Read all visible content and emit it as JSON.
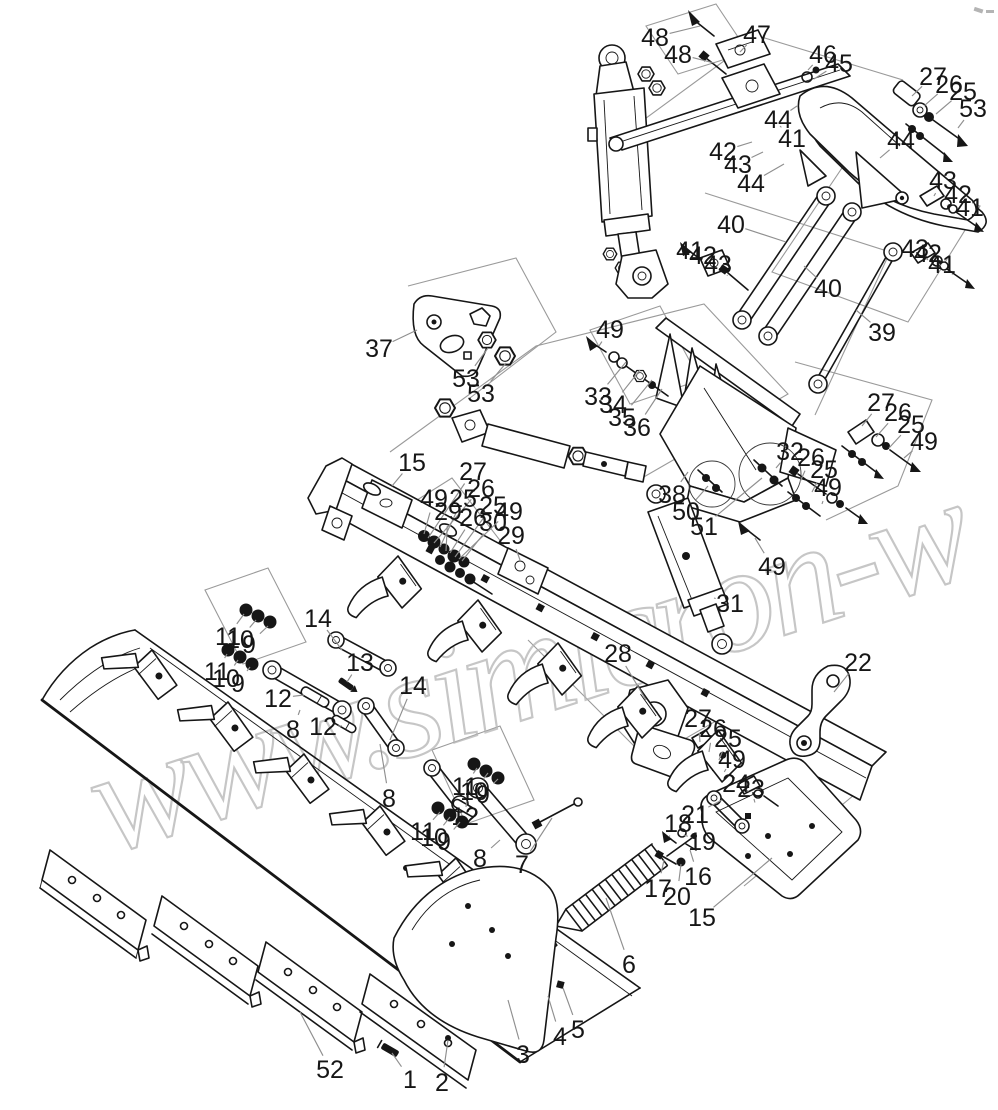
{
  "watermark": {
    "text": "www.simicron-w",
    "color": "#b4b4b4"
  },
  "diagram": {
    "background": "#ffffff",
    "colors": {
      "ink": "#161616",
      "leader": "#8f8f8f"
    },
    "callouts": [
      {
        "n": "48",
        "x": 655,
        "y": 37,
        "tx": 700,
        "ty": 26
      },
      {
        "n": "48",
        "x": 678,
        "y": 54,
        "tx": 714,
        "ty": 63
      },
      {
        "n": "47",
        "x": 757,
        "y": 34,
        "tx": 740,
        "ty": 52
      },
      {
        "n": "46",
        "x": 823,
        "y": 54,
        "tx": 808,
        "ty": 70
      },
      {
        "n": "45",
        "x": 839,
        "y": 63,
        "tx": 814,
        "ty": 79
      },
      {
        "n": "27",
        "x": 933,
        "y": 76,
        "tx": 912,
        "ty": 96
      },
      {
        "n": "26",
        "x": 949,
        "y": 84,
        "tx": 924,
        "ty": 106
      },
      {
        "n": "25",
        "x": 963,
        "y": 91,
        "tx": 936,
        "ty": 114
      },
      {
        "n": "53",
        "x": 973,
        "y": 108,
        "tx": 958,
        "ty": 128
      },
      {
        "n": "42",
        "x": 723,
        "y": 151,
        "tx": 752,
        "ty": 142
      },
      {
        "n": "43",
        "x": 738,
        "y": 164,
        "tx": 763,
        "ty": 152
      },
      {
        "n": "44",
        "x": 751,
        "y": 183,
        "tx": 784,
        "ty": 164
      },
      {
        "n": "44",
        "x": 778,
        "y": 119,
        "tx": 797,
        "ty": 106
      },
      {
        "n": "41",
        "x": 792,
        "y": 138,
        "tx": 780,
        "ty": 126
      },
      {
        "n": "44",
        "x": 901,
        "y": 140,
        "tx": 880,
        "ty": 158
      },
      {
        "n": "43",
        "x": 943,
        "y": 180,
        "tx": 934,
        "ty": 196
      },
      {
        "n": "42",
        "x": 958,
        "y": 194,
        "tx": 947,
        "ty": 206
      },
      {
        "n": "41",
        "x": 970,
        "y": 207,
        "tx": 958,
        "ty": 218
      },
      {
        "n": "43",
        "x": 915,
        "y": 248,
        "tx": 928,
        "ty": 260
      },
      {
        "n": "42",
        "x": 928,
        "y": 253,
        "tx": 941,
        "ty": 266
      },
      {
        "n": "41",
        "x": 942,
        "y": 264,
        "tx": 952,
        "ty": 274
      },
      {
        "n": "40",
        "x": 731,
        "y": 224,
        "tx": 786,
        "ty": 242
      },
      {
        "n": "41",
        "x": 690,
        "y": 250,
        "tx": 700,
        "ty": 261
      },
      {
        "n": "42",
        "x": 703,
        "y": 255,
        "tx": 712,
        "ty": 267
      },
      {
        "n": "43",
        "x": 718,
        "y": 264,
        "tx": 727,
        "ty": 275
      },
      {
        "n": "40",
        "x": 828,
        "y": 288,
        "tx": 804,
        "ty": 266
      },
      {
        "n": "39",
        "x": 882,
        "y": 332,
        "tx": 856,
        "ty": 310
      },
      {
        "n": "49",
        "x": 610,
        "y": 329,
        "tx": 599,
        "ty": 346
      },
      {
        "n": "33",
        "x": 598,
        "y": 396,
        "tx": 626,
        "ty": 362
      },
      {
        "n": "34",
        "x": 613,
        "y": 404,
        "tx": 640,
        "ty": 370
      },
      {
        "n": "35",
        "x": 622,
        "y": 417,
        "tx": 652,
        "ty": 380
      },
      {
        "n": "36",
        "x": 637,
        "y": 427,
        "tx": 662,
        "ty": 389
      },
      {
        "n": "37",
        "x": 379,
        "y": 348,
        "tx": 417,
        "ty": 330
      },
      {
        "n": "53",
        "x": 466,
        "y": 378,
        "tx": 488,
        "ty": 348
      },
      {
        "n": "53",
        "x": 481,
        "y": 393,
        "tx": 506,
        "ty": 363
      },
      {
        "n": "15",
        "x": 412,
        "y": 462,
        "tx": 392,
        "ty": 486
      },
      {
        "n": "27",
        "x": 473,
        "y": 471,
        "tx": 428,
        "ty": 538
      },
      {
        "n": "26",
        "x": 481,
        "y": 488,
        "tx": 434,
        "ty": 543
      },
      {
        "n": "49",
        "x": 434,
        "y": 498,
        "tx": 424,
        "ty": 534
      },
      {
        "n": "25",
        "x": 463,
        "y": 498,
        "tx": 440,
        "ty": 547
      },
      {
        "n": "29",
        "x": 448,
        "y": 511,
        "tx": 446,
        "ty": 551
      },
      {
        "n": "25",
        "x": 493,
        "y": 505,
        "tx": 455,
        "ty": 557
      },
      {
        "n": "26",
        "x": 473,
        "y": 517,
        "tx": 450,
        "ty": 553
      },
      {
        "n": "30",
        "x": 493,
        "y": 522,
        "tx": 462,
        "ty": 561
      },
      {
        "n": "49",
        "x": 509,
        "y": 511,
        "tx": 459,
        "ty": 559
      },
      {
        "n": "29",
        "x": 511,
        "y": 535,
        "tx": 520,
        "ty": 560
      },
      {
        "n": "32",
        "x": 790,
        "y": 451,
        "tx": 776,
        "ty": 468
      },
      {
        "n": "26",
        "x": 811,
        "y": 457,
        "tx": 800,
        "ty": 482
      },
      {
        "n": "25",
        "x": 824,
        "y": 469,
        "tx": 812,
        "ty": 492
      },
      {
        "n": "49",
        "x": 828,
        "y": 487,
        "tx": 822,
        "ty": 504
      },
      {
        "n": "27",
        "x": 881,
        "y": 402,
        "tx": 862,
        "ty": 426
      },
      {
        "n": "26",
        "x": 898,
        "y": 412,
        "tx": 876,
        "ty": 437
      },
      {
        "n": "25",
        "x": 911,
        "y": 424,
        "tx": 889,
        "ty": 448
      },
      {
        "n": "49",
        "x": 924,
        "y": 441,
        "tx": 904,
        "ty": 458
      },
      {
        "n": "38",
        "x": 672,
        "y": 494,
        "tx": 688,
        "ty": 472
      },
      {
        "n": "50",
        "x": 686,
        "y": 511,
        "tx": 708,
        "ty": 486
      },
      {
        "n": "51",
        "x": 704,
        "y": 526,
        "tx": 762,
        "ty": 478
      },
      {
        "n": "49",
        "x": 772,
        "y": 566,
        "tx": 755,
        "ty": 538
      },
      {
        "n": "28",
        "x": 618,
        "y": 653,
        "tx": 646,
        "ty": 700
      },
      {
        "n": "22",
        "x": 858,
        "y": 662,
        "tx": 834,
        "ty": 692
      },
      {
        "n": "31",
        "x": 730,
        "y": 603,
        "tx": 714,
        "ty": 598
      },
      {
        "n": "14",
        "x": 318,
        "y": 618,
        "tx": 342,
        "ty": 650
      },
      {
        "n": "13",
        "x": 360,
        "y": 662,
        "tx": 347,
        "ty": 682
      },
      {
        "n": "14",
        "x": 413,
        "y": 685,
        "tx": 390,
        "ty": 740
      },
      {
        "n": "11",
        "x": 228,
        "y": 636,
        "tx": 244,
        "ty": 614
      },
      {
        "n": "10",
        "x": 240,
        "y": 639,
        "tx": 256,
        "ty": 620
      },
      {
        "n": "9",
        "x": 249,
        "y": 644,
        "tx": 268,
        "ty": 626
      },
      {
        "n": "11",
        "x": 217,
        "y": 671,
        "tx": 227,
        "ty": 654
      },
      {
        "n": "10",
        "x": 226,
        "y": 678,
        "tx": 238,
        "ty": 660
      },
      {
        "n": "9",
        "x": 238,
        "y": 683,
        "tx": 250,
        "ty": 667
      },
      {
        "n": "12",
        "x": 278,
        "y": 698,
        "tx": 304,
        "ty": 695
      },
      {
        "n": "8",
        "x": 293,
        "y": 729,
        "tx": 300,
        "ty": 710
      },
      {
        "n": "12",
        "x": 323,
        "y": 726,
        "tx": 342,
        "ty": 726
      },
      {
        "n": "8",
        "x": 389,
        "y": 798,
        "tx": 380,
        "ty": 744
      },
      {
        "n": "11",
        "x": 465,
        "y": 786,
        "tx": 477,
        "ty": 768
      },
      {
        "n": "10",
        "x": 474,
        "y": 791,
        "tx": 488,
        "ty": 773
      },
      {
        "n": "9",
        "x": 483,
        "y": 794,
        "tx": 498,
        "ty": 779
      },
      {
        "n": "12",
        "x": 465,
        "y": 816,
        "tx": 466,
        "ty": 807
      },
      {
        "n": "11",
        "x": 423,
        "y": 831,
        "tx": 440,
        "ty": 812
      },
      {
        "n": "10",
        "x": 434,
        "y": 837,
        "tx": 450,
        "ty": 817
      },
      {
        "n": "9",
        "x": 444,
        "y": 841,
        "tx": 460,
        "ty": 822
      },
      {
        "n": "8",
        "x": 480,
        "y": 858,
        "tx": 500,
        "ty": 840
      },
      {
        "n": "7",
        "x": 522,
        "y": 864,
        "tx": 552,
        "ty": 818
      },
      {
        "n": "52",
        "x": 330,
        "y": 1069,
        "tx": 300,
        "ty": 1012
      },
      {
        "n": "1",
        "x": 410,
        "y": 1079,
        "tx": 392,
        "ty": 1053
      },
      {
        "n": "2",
        "x": 442,
        "y": 1082,
        "tx": 448,
        "ty": 1040
      },
      {
        "n": "3",
        "x": 523,
        "y": 1054,
        "tx": 508,
        "ty": 1000
      },
      {
        "n": "4",
        "x": 560,
        "y": 1036,
        "tx": 548,
        "ty": 996
      },
      {
        "n": "5",
        "x": 578,
        "y": 1029,
        "tx": 563,
        "ty": 988
      },
      {
        "n": "6",
        "x": 629,
        "y": 964,
        "tx": 606,
        "ty": 898
      },
      {
        "n": "15",
        "x": 702,
        "y": 917,
        "tx": 772,
        "ty": 858
      },
      {
        "n": "17",
        "x": 658,
        "y": 888,
        "tx": 664,
        "ty": 860
      },
      {
        "n": "20",
        "x": 677,
        "y": 896,
        "tx": 681,
        "ty": 864
      },
      {
        "n": "16",
        "x": 698,
        "y": 876,
        "tx": 690,
        "ty": 850
      },
      {
        "n": "19",
        "x": 702,
        "y": 841,
        "tx": 684,
        "ty": 835
      },
      {
        "n": "18",
        "x": 678,
        "y": 823,
        "tx": 669,
        "ty": 837
      },
      {
        "n": "21",
        "x": 695,
        "y": 814,
        "tx": 722,
        "ty": 800
      },
      {
        "n": "27",
        "x": 698,
        "y": 718,
        "tx": 700,
        "ty": 742
      },
      {
        "n": "26",
        "x": 713,
        "y": 728,
        "tx": 709,
        "ty": 752
      },
      {
        "n": "25",
        "x": 728,
        "y": 738,
        "tx": 719,
        "ty": 760
      },
      {
        "n": "49",
        "x": 732,
        "y": 759,
        "tx": 726,
        "ty": 769
      },
      {
        "n": "24",
        "x": 736,
        "y": 783,
        "tx": 745,
        "ty": 789
      },
      {
        "n": "23",
        "x": 751,
        "y": 788,
        "tx": 754,
        "ty": 799
      }
    ]
  }
}
